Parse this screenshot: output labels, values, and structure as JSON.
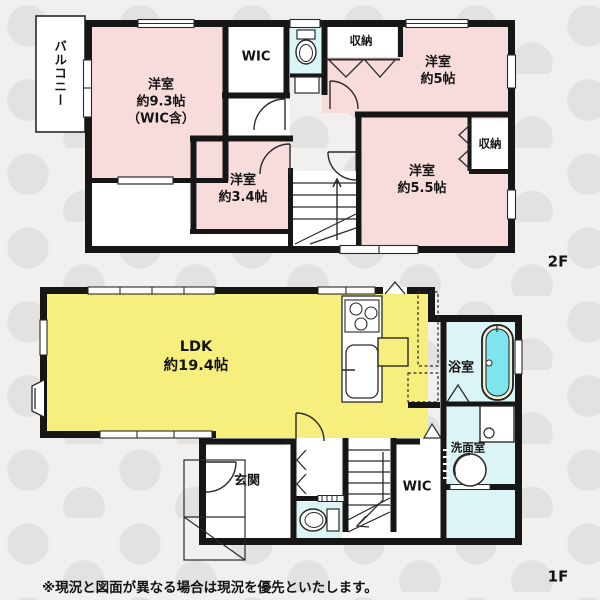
{
  "floor2": {
    "label": "2F",
    "balcony_label": "バルコニー",
    "rooms": {
      "bedroom_93": {
        "name": "洋室",
        "size": "約9.3帖",
        "note": "（WIC含）"
      },
      "wic": {
        "name": "WIC"
      },
      "closet_north": {
        "name": "収納"
      },
      "bedroom_5": {
        "name": "洋室",
        "size": "約5帖"
      },
      "closet_east": {
        "name": "収納"
      },
      "bedroom_55": {
        "name": "洋室",
        "size": "約5.5帖"
      },
      "bedroom_34": {
        "name": "洋室",
        "size": "約3.4帖"
      }
    }
  },
  "floor1": {
    "label": "1F",
    "rooms": {
      "ldk": {
        "name": "LDK",
        "size": "約19.4帖"
      },
      "bathroom": {
        "name": "浴室"
      },
      "washroom": {
        "name": "洗面室"
      },
      "entrance": {
        "name": "玄関"
      },
      "wic": {
        "name": "WIC"
      }
    }
  },
  "disclaimer": "※現況と図面が異なる場合は現況を優先といたします。",
  "colors": {
    "room_pink": "#f8dcdc",
    "room_yellow": "#f6ef7e",
    "room_cyan": "#dbf4f5",
    "bathtub_cyan": "#7fe4ec",
    "wall_black": "#161616",
    "background": "#f1f0ee"
  }
}
